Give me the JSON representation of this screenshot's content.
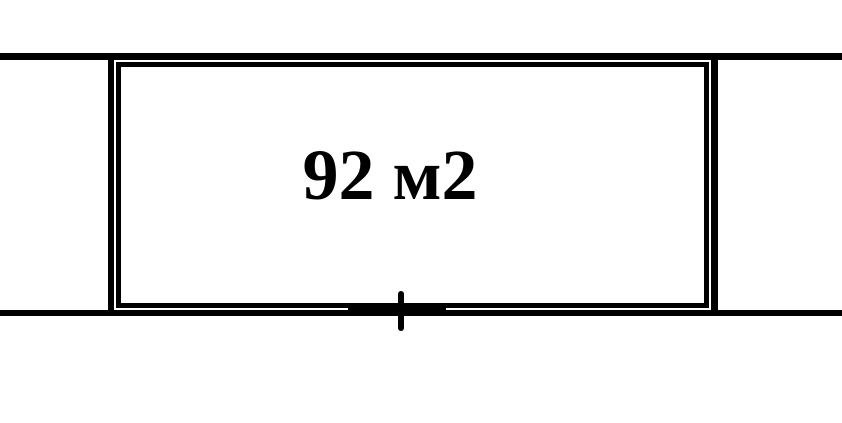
{
  "canvas": {
    "background_color": "#ffffff",
    "line_color": "#000000"
  },
  "floor_plan": {
    "room": {
      "area_label": "92 м2"
    }
  }
}
